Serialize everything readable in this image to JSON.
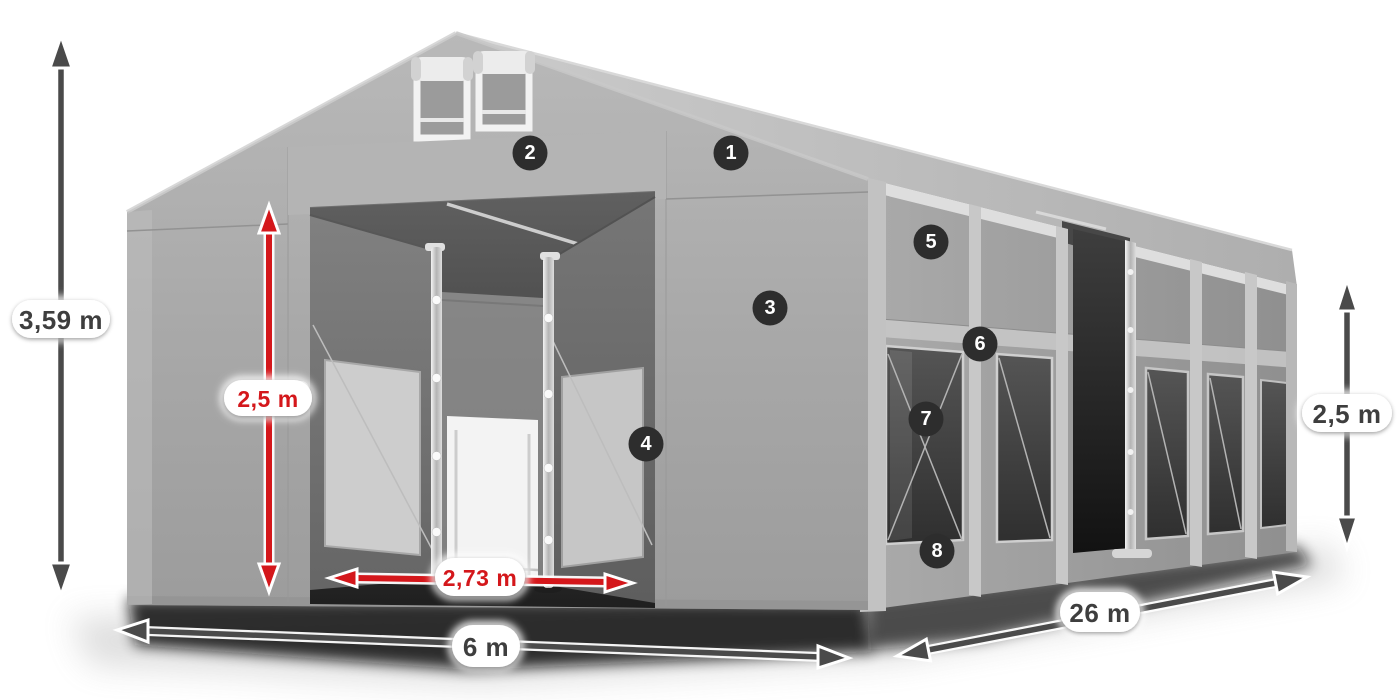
{
  "diagram_labels": {
    "total_height": "3,59 m",
    "entrance_height": "2,5 m",
    "entrance_width": "2,73 m",
    "front_width": "6 m",
    "length": "26 m",
    "side_height": "2,5 m"
  },
  "feature_badges": [
    {
      "number": "1"
    },
    {
      "number": "2"
    },
    {
      "number": "3"
    },
    {
      "number": "4"
    },
    {
      "number": "5"
    },
    {
      "number": "6"
    },
    {
      "number": "7"
    },
    {
      "number": "8"
    }
  ],
  "colors": {
    "dimension_accent_red": "#d4171b",
    "dimension_gray": "#3e3e3e",
    "badge_background": "#2d2d2d",
    "badge_text": "#ffffff",
    "tent_fabric_gray": "#a8a8a8",
    "background": "#ffffff"
  }
}
